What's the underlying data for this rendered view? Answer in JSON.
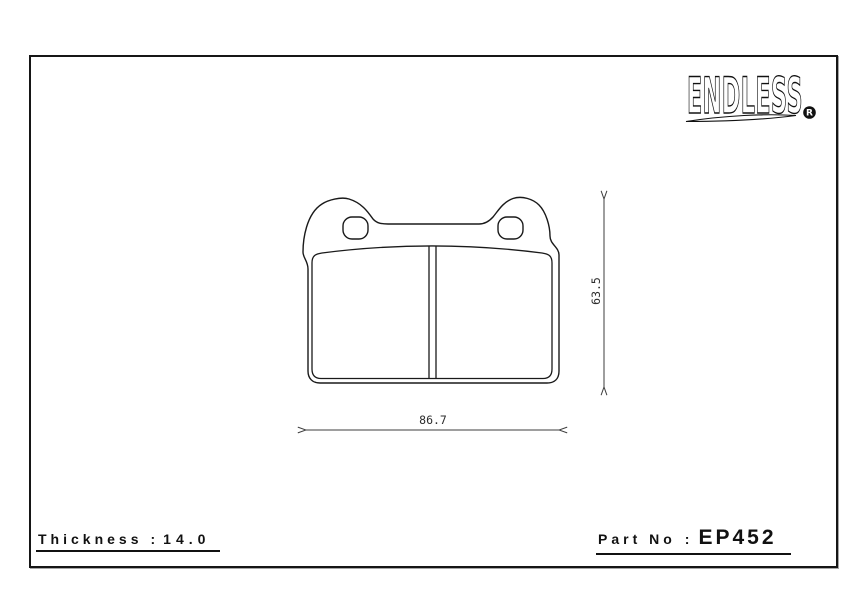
{
  "logo": {
    "text": "ENDLESS",
    "registered_mark": "R"
  },
  "drawing": {
    "dimensions": {
      "width_mm": "86.7",
      "height_mm": "63.5"
    }
  },
  "footer": {
    "thickness_label": "Thickness",
    "separator": ":",
    "thickness_value": "14.0",
    "part_no_label": "Part No",
    "part_no_value": "EP452"
  },
  "colors": {
    "background": "#ffffff",
    "line": "#1a1a1a",
    "dimension_line": "#3c3c3c"
  }
}
